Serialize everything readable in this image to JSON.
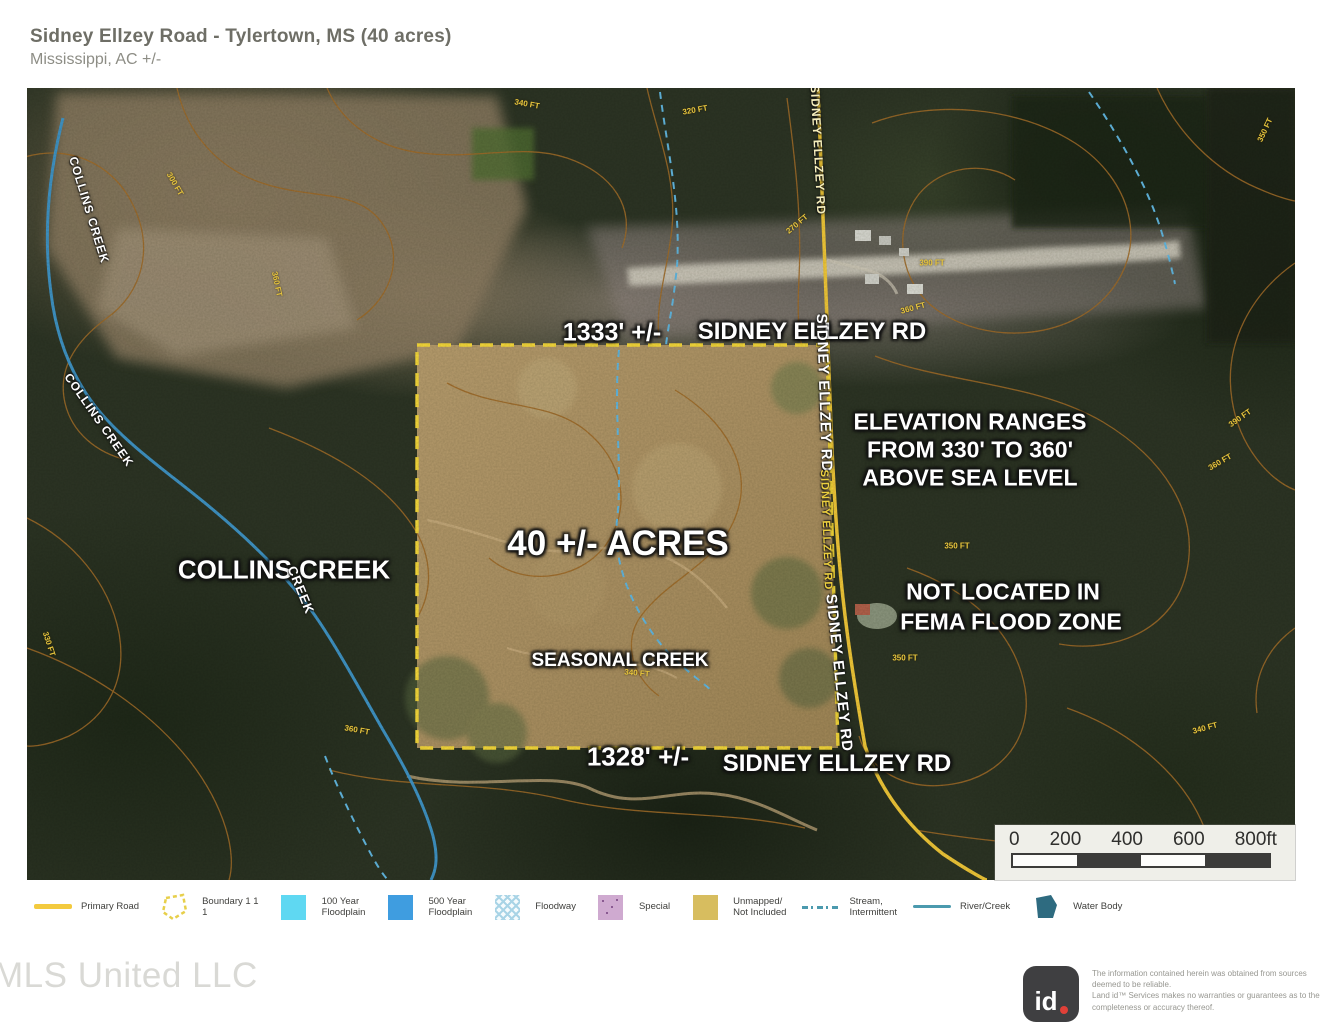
{
  "header": {
    "title": "Sidney Ellzey Road - Tylertown, MS (40 acres)",
    "subtitle": "Mississippi,  AC +/-"
  },
  "map": {
    "attribution": "mapbox",
    "labels": [
      {
        "name": "dim-top",
        "text": "1333' +/-",
        "x": 585,
        "y": 245,
        "size": 25
      },
      {
        "name": "road-label-top",
        "text": "SIDNEY ELLZEY RD",
        "x": 785,
        "y": 244,
        "size": 24
      },
      {
        "name": "elevation-line-1",
        "text": "ELEVATION RANGES",
        "x": 943,
        "y": 334,
        "size": 23
      },
      {
        "name": "elevation-line-2",
        "text": "FROM 330' TO 360'",
        "x": 943,
        "y": 362,
        "size": 23
      },
      {
        "name": "elevation-line-3",
        "text": "ABOVE SEA LEVEL",
        "x": 943,
        "y": 390,
        "size": 23
      },
      {
        "name": "acreage",
        "text": "40 +/- ACRES",
        "x": 591,
        "y": 456,
        "size": 35
      },
      {
        "name": "collins-creek",
        "text": "COLLINS CREEK",
        "x": 257,
        "y": 482,
        "size": 26
      },
      {
        "name": "fema-line-1",
        "text": "NOT LOCATED IN",
        "x": 976,
        "y": 504,
        "size": 23
      },
      {
        "name": "fema-line-2",
        "text": "FEMA FLOOD ZONE",
        "x": 984,
        "y": 534,
        "size": 23
      },
      {
        "name": "seasonal-creek",
        "text": "SEASONAL CREEK",
        "x": 593,
        "y": 573,
        "size": 19
      },
      {
        "name": "dim-bottom",
        "text": "1328' +/-",
        "x": 611,
        "y": 669,
        "size": 26
      },
      {
        "name": "road-label-bottom",
        "text": "SIDNEY ELLZEY RD",
        "x": 810,
        "y": 676,
        "size": 24
      }
    ],
    "rotated_labels": [
      {
        "name": "road-top-vert",
        "text": "SIDNEY ELLZEY RD",
        "x": 791,
        "y": 62,
        "size": 12,
        "rot": 87,
        "color": "#f5eebc"
      },
      {
        "name": "road-mid-vert",
        "text": "SIDNEY ELLZEY RD",
        "x": 797,
        "y": 305,
        "size": 15,
        "rot": 88,
        "color": "#ffffff"
      },
      {
        "name": "road-small-vert",
        "text": "SIDNEY ELLZEY RD",
        "x": 799,
        "y": 442,
        "size": 11,
        "rot": 88,
        "color": "#eccf3f"
      },
      {
        "name": "road-lower-vert",
        "text": "SIDNEY ELLZEY RD",
        "x": 812,
        "y": 585,
        "size": 15,
        "rot": 84,
        "color": "#ffffff"
      },
      {
        "name": "collins-creek-small-1",
        "text": "COLLINS CREEK",
        "x": 62,
        "y": 122,
        "size": 12,
        "rot": 73,
        "color": "#ffffff"
      },
      {
        "name": "collins-creek-small-2",
        "text": "COLLINS CREEK",
        "x": 72,
        "y": 332,
        "size": 12,
        "rot": 55,
        "color": "#ffffff"
      },
      {
        "name": "collins-creek-small-3",
        "text": "CREEK",
        "x": 274,
        "y": 502,
        "size": 13,
        "rot": 68,
        "color": "#ffffff"
      }
    ],
    "contour_labels": [
      {
        "text": "340 FT",
        "x": 500,
        "y": 16,
        "rot": 10
      },
      {
        "text": "320 FT",
        "x": 668,
        "y": 22,
        "rot": -10
      },
      {
        "text": "300 FT",
        "x": 148,
        "y": 96,
        "rot": 60
      },
      {
        "text": "360 FT",
        "x": 250,
        "y": 196,
        "rot": 78
      },
      {
        "text": "270 FT",
        "x": 770,
        "y": 136,
        "rot": -40
      },
      {
        "text": "390 FT",
        "x": 905,
        "y": 175,
        "rot": 0
      },
      {
        "text": "360 FT",
        "x": 886,
        "y": 220,
        "rot": -15
      },
      {
        "text": "350 FT",
        "x": 1238,
        "y": 42,
        "rot": -65
      },
      {
        "text": "390 FT",
        "x": 1213,
        "y": 330,
        "rot": -35
      },
      {
        "text": "360 FT",
        "x": 1193,
        "y": 374,
        "rot": -30
      },
      {
        "text": "350 FT",
        "x": 930,
        "y": 458,
        "rot": 0
      },
      {
        "text": "350 FT",
        "x": 878,
        "y": 570,
        "rot": 0
      },
      {
        "text": "340 FT",
        "x": 1178,
        "y": 640,
        "rot": -15
      },
      {
        "text": "340 FT",
        "x": 610,
        "y": 585,
        "rot": 5
      },
      {
        "text": "360 FT",
        "x": 330,
        "y": 642,
        "rot": 10
      },
      {
        "text": "330 FT",
        "x": 22,
        "y": 556,
        "rot": 72
      }
    ],
    "scale_ticks": [
      "0",
      "200",
      "400",
      "600",
      "800ft"
    ]
  },
  "legend": {
    "items": [
      {
        "key": "primary-road",
        "label": "Primary Road"
      },
      {
        "key": "boundary",
        "label": "Boundary 1 1\n1"
      },
      {
        "key": "floodplain-100",
        "label": "100 Year\nFloodplain"
      },
      {
        "key": "floodplain-500",
        "label": "500 Year\nFloodplain"
      },
      {
        "key": "floodway",
        "label": "Floodway"
      },
      {
        "key": "special",
        "label": "Special"
      },
      {
        "key": "unmapped",
        "label": "Unmapped/\nNot Included"
      },
      {
        "key": "stream-intermittent",
        "label": "Stream,\nIntermittent"
      },
      {
        "key": "river-creek",
        "label": "River/Creek"
      },
      {
        "key": "water-body",
        "label": "Water Body"
      }
    ]
  },
  "footer": {
    "brand": "MLS United LLC",
    "logo_text": "id",
    "disclaimer": "The information contained herein was obtained from sources\ndeemed to be reliable.\n Land id™ Services makes no warranties or guarantees as to the\ncompleteness or accuracy thereof."
  },
  "colors": {
    "boundary_yellow": "#f8da3a",
    "road_yellow": "#f2c838",
    "creek_blue": "#3f94c8",
    "stream_blue": "#62b8e4",
    "contour_orange": "#a06b28",
    "contour_label_yellow": "#e7c53d"
  }
}
